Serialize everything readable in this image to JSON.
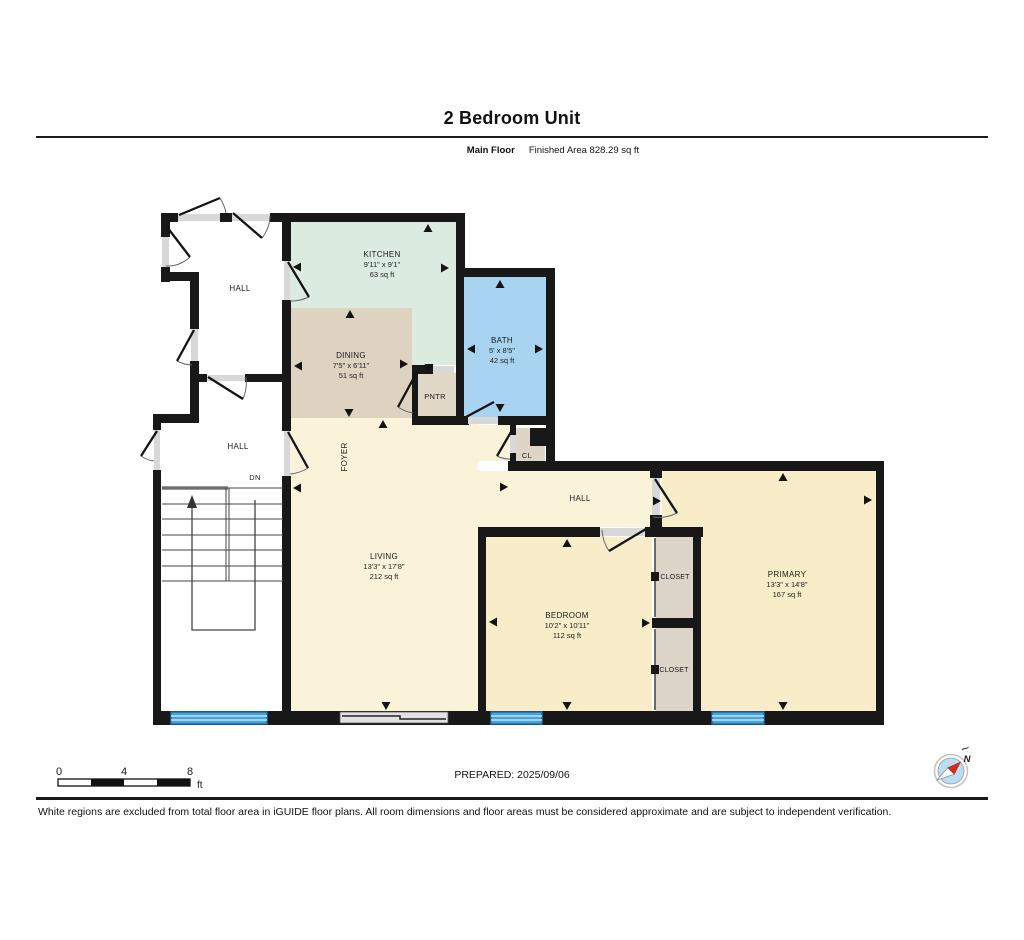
{
  "header": {
    "title": "2 Bedroom Unit",
    "floor_label": "Main Floor",
    "finished_area": "Finished Area 828.29 sq ft"
  },
  "rooms": [
    {
      "id": "kitchen",
      "name": "KITCHEN",
      "dims": "9'11\" x 9'1\"",
      "area": "63 sq ft"
    },
    {
      "id": "dining",
      "name": "DINING",
      "dims": "7'5\" x 6'11\"",
      "area": "51 sq ft"
    },
    {
      "id": "bath",
      "name": "BATH",
      "dims": "5' x 8'5\"",
      "area": "42 sq ft"
    },
    {
      "id": "living",
      "name": "LIVING",
      "dims": "13'3\" x 17'8\"",
      "area": "212 sq ft"
    },
    {
      "id": "bedroom",
      "name": "BEDROOM",
      "dims": "10'2\" x 10'11\"",
      "area": "112 sq ft"
    },
    {
      "id": "primary",
      "name": "PRIMARY",
      "dims": "13'3\" x 14'8\"",
      "area": "167 sq ft"
    }
  ],
  "labels": {
    "hall_top": "HALL",
    "hall_mid": "HALL",
    "hall_right": "HALL",
    "foyer": "FOYER",
    "down": "DN",
    "pantry": "PNTR",
    "closet_abbr": "CL",
    "closet_upper": "CLOSET",
    "closet_lower": "CLOSET"
  },
  "scale_bar": {
    "ticks": [
      "0",
      "4",
      "8"
    ],
    "unit": "ft"
  },
  "compass": {
    "north": "N"
  },
  "footer": {
    "prepared": "PREPARED: 2025/09/06",
    "disclaimer": "White regions are excluded from total floor area in iGUIDE floor plans. All room dimensions and floor areas must be considered approximate and are subject to independent verification."
  },
  "colors": {
    "wall": "#181818",
    "kitchen": "#dcebe0",
    "dining": "#ddd3c0",
    "pantry": "#e0d7c6",
    "bath": "#a8d3f1",
    "living_cream": "#faf3da",
    "bedroom_cream": "#f8edc8",
    "closet": "#ddd5c7",
    "threshold": "#d8d8d8",
    "window_glass": "#4aa3d8",
    "window_frame": "#1d6fa5",
    "compass_blue": "#b9ddf3",
    "compass_red": "#d62a1c"
  }
}
